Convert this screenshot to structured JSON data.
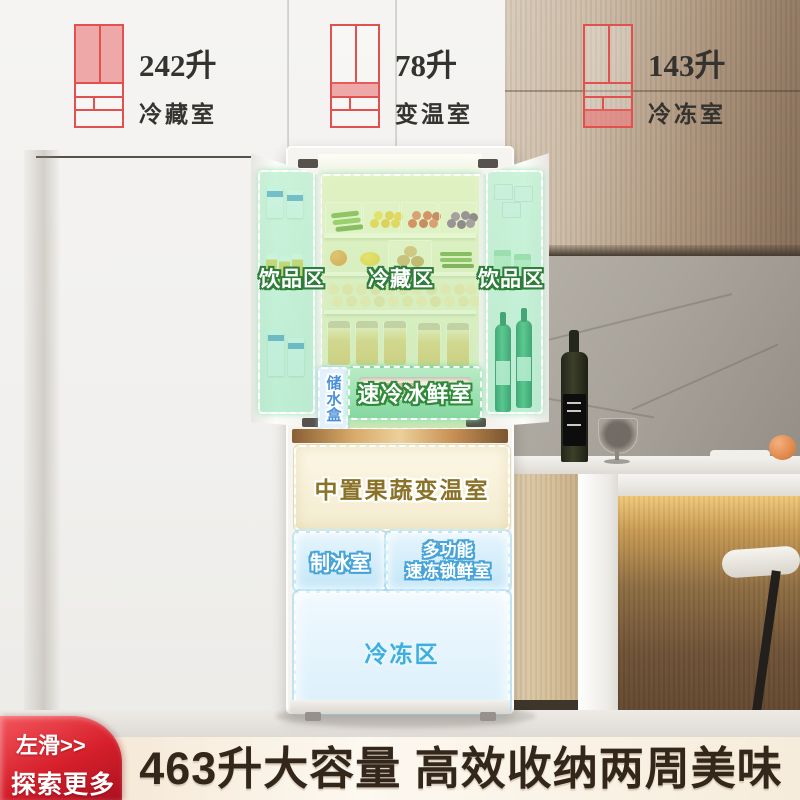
{
  "specs": [
    {
      "volume": "242升",
      "room": "冷藏室",
      "highlight": "doors",
      "icon": "fridge-diagram-icon"
    },
    {
      "volume": "78升",
      "room": "变温室",
      "highlight": "drawer",
      "icon": "fridge-diagram-icon"
    },
    {
      "volume": "143升",
      "room": "冷冻室",
      "highlight": "bottom",
      "icon": "fridge-diagram-icon"
    }
  ],
  "fridge": {
    "zones": {
      "left_door": "饮品区",
      "center": "冷藏区",
      "right_door": "饮品区",
      "water_box": "储水盒",
      "quick_cool": "速冷冰鲜室",
      "mid_drawer": "中置果蔬变温室",
      "ice_room": "制冰室",
      "multi_room_line1": "多功能",
      "multi_room_line2": "速冻锁鲜室",
      "freezer": "冷冻区"
    }
  },
  "banner": {
    "title": "463升大容量 高效收纳两周美味"
  },
  "badge": {
    "line1": "左滑>>",
    "line2": "探索更多"
  },
  "colors": {
    "accent_red": "#e0514f",
    "badge_red": "#d61f2b",
    "fresh_zone_green": "#84d7a0",
    "cool_zone_blue": "#c3e6f7",
    "variable_zone_cream": "#f8f2da",
    "freezer_text_blue": "#3fadde",
    "banner_bg": "#f8edda",
    "banner_text": "#33261a"
  }
}
